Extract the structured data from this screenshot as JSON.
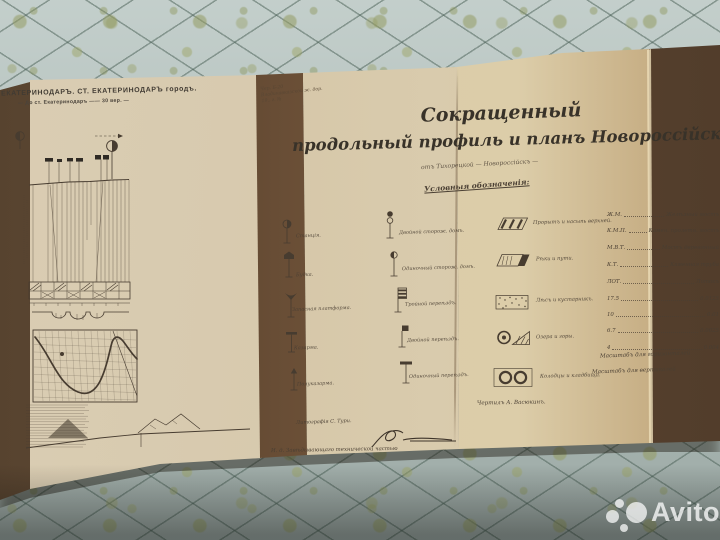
{
  "colors": {
    "quilt": "#b6c4c0",
    "paper": "#d7c9ac",
    "fold_shadow": "#6b513c",
    "ink": "#4a3f33",
    "watermark": "#ffffff"
  },
  "watermark": {
    "label": "Avito"
  },
  "doc": {
    "corner_title_1": "ЕКАТЕРИНОДАРЪ. СТ. ЕКАТЕРИНОДАРЪ городъ.",
    "corner_title_2": "— До ст. Екатеринодаръ —— 30 вер. —",
    "stamp_note_1": "Чер. Б-20",
    "stamp_note_2": "Владикавказской ж. дор.",
    "stamp_note_3": "19.. г. №",
    "title_1": "Сокращенный",
    "title_2": "продольный профиль и планъ Новороссійской вѣт",
    "subtitle": "отъ Тихорецкой — Новороссійскъ —",
    "legend_heading": "Условныя обозначенія:",
    "legend_col1": [
      {
        "icon": "station-signal-icon",
        "label": "Станція."
      },
      {
        "icon": "booth-signal-icon",
        "label": "Будка."
      },
      {
        "icon": "reserve-platform-icon",
        "label": "Запасная платформа."
      },
      {
        "icon": "barracks-signal-icon",
        "label": "Казарма."
      },
      {
        "icon": "half-barracks-signal-icon",
        "label": "Полуказарма."
      }
    ],
    "legend_col2": [
      {
        "icon": "double-watchhouse-icon",
        "label": "Двойной сторож. домъ."
      },
      {
        "icon": "single-watchhouse-icon",
        "label": "Одиночный сторож. домъ."
      },
      {
        "icon": "triple-crossing-icon",
        "label": "Тройной переѣздъ."
      },
      {
        "icon": "double-crossing-icon",
        "label": "Двойной переѣздъ."
      },
      {
        "icon": "single-crossing-icon",
        "label": "Одиночный переѣздъ."
      }
    ],
    "legend_symbols": [
      {
        "icon": "cut-and-fill-icon",
        "label": "Прорытъ и насыпь верхней."
      },
      {
        "icon": "rivers-icon",
        "label": "Рѣки и пути."
      },
      {
        "icon": "forest-shrub-icon",
        "label": "Лѣсъ и кустарникъ."
      },
      {
        "icon": "lakes-mountains-icon",
        "label": "Озера и горы."
      },
      {
        "icon": "wells-cemeteries-icon",
        "label": "Колодцы и кладбища."
      }
    ],
    "abbrev": [
      {
        "k": "Ж.М.",
        "v": "Желѣзный мостъ"
      },
      {
        "k": "К.М.П.",
        "v": "Камен. пролетн. мостъ"
      },
      {
        "k": "М.В.Т.",
        "v": "Мостъ деревянный"
      },
      {
        "k": "К.Т.",
        "v": "Каменная труба"
      },
      {
        "k": "ЛОТ.",
        "v": "Лотокъ"
      },
      {
        "k": "17.5",
        "v": "0.0125"
      },
      {
        "k": "10",
        "v": "0.01"
      },
      {
        "k": "6.7",
        "v": "0.0025"
      },
      {
        "k": "4",
        "v": "0.004"
      }
    ],
    "scale_note_1": "Масштабъ для горизонталей",
    "scale_note_2": "Масштабъ для вертикалей",
    "drafted_by": "Чертилъ А. Васюкинъ.",
    "lithography": "Литографія С. Тури.",
    "official_line": "И. д. Завѣдывающаго технической частью"
  }
}
